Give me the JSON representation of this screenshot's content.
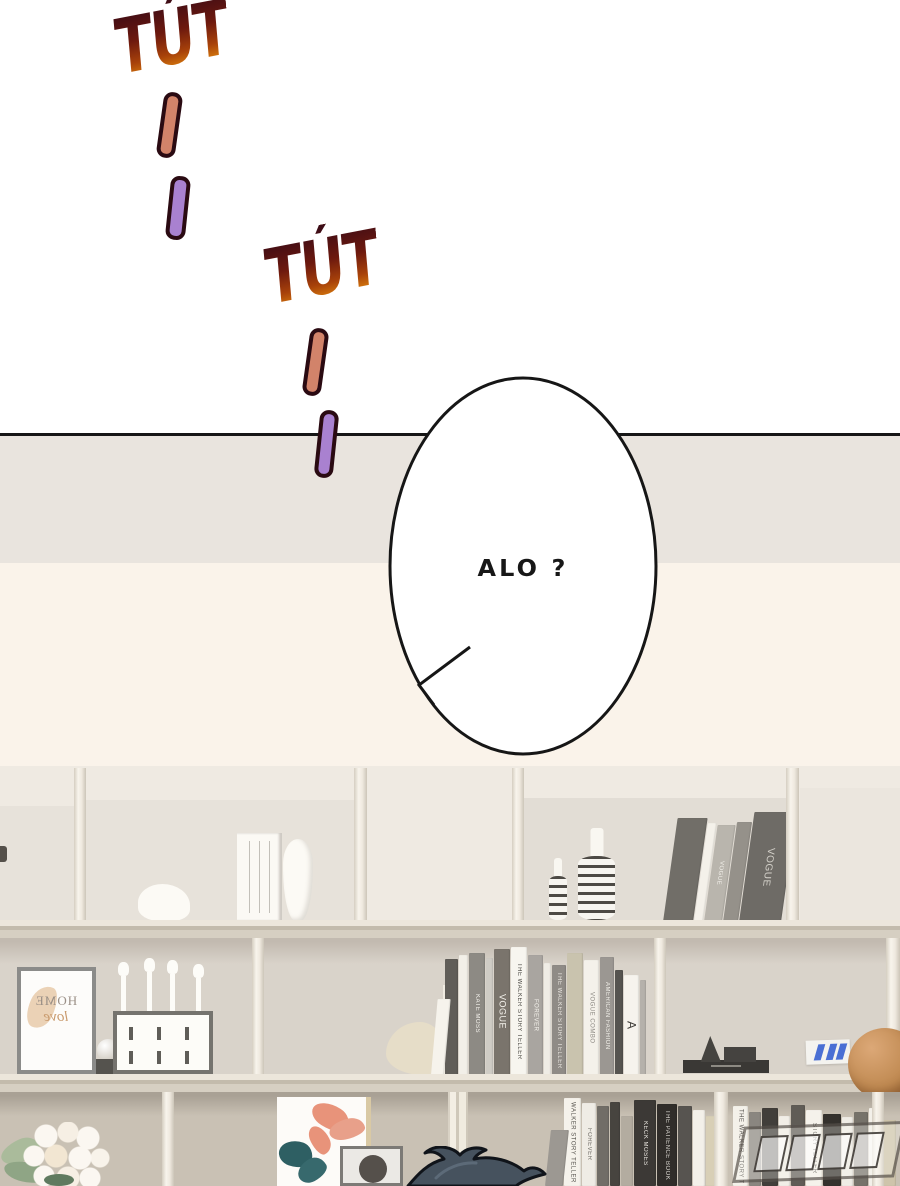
{
  "sfx": {
    "tut1": "TÚT",
    "tut2": "TÚT"
  },
  "speech": {
    "text": "ALO ?"
  },
  "frame_print": {
    "word1": "HOME",
    "word2": "love"
  },
  "colors": {
    "panel_white": "#ffffff",
    "divider_line": "#161616",
    "band_gray": "#e9e4de",
    "band_cream": "#faf3ea",
    "shelf_light": "#efeae2",
    "wall_mid": "#d9d3ca",
    "wall_bottom": "#c9c1b4",
    "sfx_gradient_top": "#3d0c16",
    "sfx_gradient_bottom": "#f3a41c",
    "dash_orange": "#d2836a",
    "dash_purple": "#a981d0",
    "hair_blue": "#46525e",
    "basketball_orange": "#c08a52"
  },
  "bookshelf": {
    "top_right_books": [
      {
        "w": 30,
        "h": 104,
        "c": "#716e68",
        "t": "",
        "tc": "#d8d5cf",
        "lean": -8
      },
      {
        "w": 9,
        "h": 99,
        "c": "#f4f1ea",
        "lean": -8
      },
      {
        "w": 18,
        "h": 97,
        "c": "#b9b5ad",
        "t": "VOGUE",
        "tc": "#f4f2ec",
        "lean": -8
      },
      {
        "w": 15,
        "h": 100,
        "c": "#95918a",
        "lean": -8
      },
      {
        "w": 42,
        "h": 110,
        "c": "#6e6b66",
        "t": "VOGUE",
        "tc": "#d5d2cb",
        "ts": 10,
        "lean": -8
      }
    ],
    "middle_books": [
      {
        "w": 13,
        "h": 76,
        "c": "#f6f3ec",
        "lean": -5
      },
      {
        "w": 13,
        "h": 116,
        "c": "#605d58",
        "tc": "#cfccc6"
      },
      {
        "w": 9,
        "h": 120,
        "c": "#f2efe8"
      },
      {
        "w": 16,
        "h": 122,
        "c": "#8d8a84",
        "t": "KATE MOSS",
        "tc": "#f4f2ec"
      },
      {
        "w": 7,
        "h": 117,
        "c": "#cfccc5"
      },
      {
        "w": 16,
        "h": 126,
        "c": "#7a746c",
        "t": "VOGUE",
        "tc": "#f6f4ee",
        "ts": 9
      },
      {
        "w": 16,
        "h": 128,
        "c": "#f7f5ef",
        "t": "THE WALKER STORY TELLER",
        "tc": "#4a4843"
      },
      {
        "w": 15,
        "h": 120,
        "c": "#a9a5a0",
        "t": "FOREVER",
        "tc": "#f6f4ee"
      },
      {
        "w": 7,
        "h": 112,
        "c": "#efece5"
      },
      {
        "w": 14,
        "h": 110,
        "c": "#8f8b86",
        "t": "THE WALKER STORY TELLER",
        "tc": "#e9e6e0"
      },
      {
        "w": 16,
        "h": 122,
        "c": "#c9c3ae"
      },
      {
        "w": 15,
        "h": 115,
        "c": "#f4f1ea",
        "t": "VOGUE COMBO",
        "tc": "#8a8781"
      },
      {
        "w": 14,
        "h": 118,
        "c": "#9b9792",
        "t": "AMERICAN FASHION",
        "tc": "#f2f0ea"
      },
      {
        "w": 8,
        "h": 105,
        "c": "#565450"
      },
      {
        "w": 15,
        "h": 100,
        "c": "#f6f3ed",
        "t": "A",
        "tc": "#3e3c38",
        "ts": 12
      },
      {
        "w": 6,
        "h": 95,
        "c": "#b5b1ab"
      }
    ],
    "bottom_left_books": [
      {
        "w": 18,
        "h": 56,
        "c": "#9c9892",
        "lean": -6
      },
      {
        "w": 17,
        "h": 88,
        "c": "#f5f2eb",
        "t": "WALKER STORY TELLER",
        "tc": "#55524d"
      },
      {
        "w": 14,
        "h": 83,
        "c": "#efece5",
        "t": "FOREVER",
        "tc": "#6e6b65"
      },
      {
        "w": 12,
        "h": 80,
        "c": "#716d67"
      },
      {
        "w": 10,
        "h": 84,
        "c": "#47443f"
      },
      {
        "w": 12,
        "h": 70,
        "c": "#b3aca0"
      },
      {
        "w": 22,
        "h": 86,
        "c": "#3c3936",
        "t": "KECK MOSES",
        "tc": "#e8e5df"
      },
      {
        "w": 20,
        "h": 82,
        "c": "#302d2a",
        "t": "THE PATIENCE BOOK",
        "tc": "#d8d5cf"
      },
      {
        "w": 14,
        "h": 80,
        "c": "#575450"
      },
      {
        "w": 12,
        "h": 76,
        "c": "#f3f0e9"
      },
      {
        "w": 14,
        "h": 70,
        "c": "#d8cfb6"
      }
    ],
    "bottom_right_books": [
      {
        "w": 15,
        "h": 80,
        "c": "#f4f1ea",
        "t": "THE WALKER STORY TELLER",
        "tc": "#5a5753"
      },
      {
        "w": 12,
        "h": 74,
        "c": "#8a8680"
      },
      {
        "w": 16,
        "h": 78,
        "c": "#413e3a",
        "tc": "#ccc9c3"
      },
      {
        "w": 11,
        "h": 70,
        "c": "#f1eee7"
      },
      {
        "w": 14,
        "h": 81,
        "c": "#605c56"
      },
      {
        "w": 16,
        "h": 76,
        "c": "#f5f2eb",
        "t": "STORY TELLER",
        "tc": "#56534e"
      },
      {
        "w": 18,
        "h": 72,
        "c": "#34312d"
      },
      {
        "w": 11,
        "h": 69,
        "c": "#efece5"
      },
      {
        "w": 14,
        "h": 74,
        "c": "#76726a"
      },
      {
        "w": 14,
        "h": 78,
        "c": "#f3f0e9",
        "t": "FOREVER",
        "tc": "#67645e"
      },
      {
        "w": 12,
        "h": 66,
        "c": "#cec4ab"
      }
    ]
  }
}
